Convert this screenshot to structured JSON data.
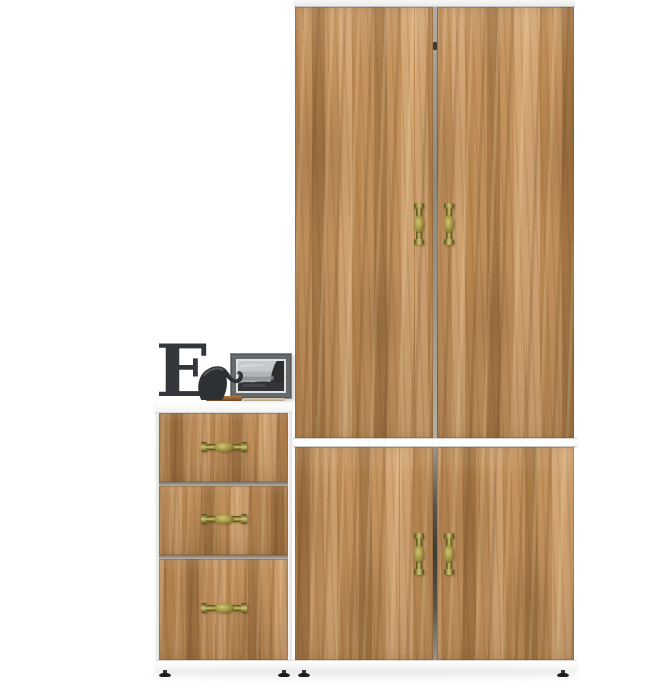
{
  "page": {
    "background": "#ffffff"
  },
  "colors": {
    "bg": "#ffffff",
    "wood_base": "#c4935e",
    "wood_light": "#d4a674",
    "wood_mid": "#bd8b54",
    "wood_dark": "#a87a48",
    "band_white": "#fdfdfd",
    "gap_gray": "#8f897f",
    "gap_dark": "#3f3a33",
    "brass_light": "#d3c573",
    "brass_mid": "#948739",
    "brass_dark": "#4f4819",
    "letter_color": "#33363a",
    "figurine_dark": "#2e3134",
    "frame_mat": "#666a6d",
    "frame_edge": "#54575a",
    "photo_border": "#dfe1e2",
    "tray_brown": "#8e5c33",
    "pencil_beige": "#cbbb9e",
    "foot_black": "#1c1c1c"
  },
  "decor": {
    "letter": "E"
  },
  "furniture": {
    "wardrobe": {
      "upper_doors": 2,
      "lower_doors": 2,
      "vertical_handles": 4
    },
    "drawer_chest": {
      "drawers": 3,
      "horizontal_handles": 3
    },
    "feet_count": 4
  }
}
